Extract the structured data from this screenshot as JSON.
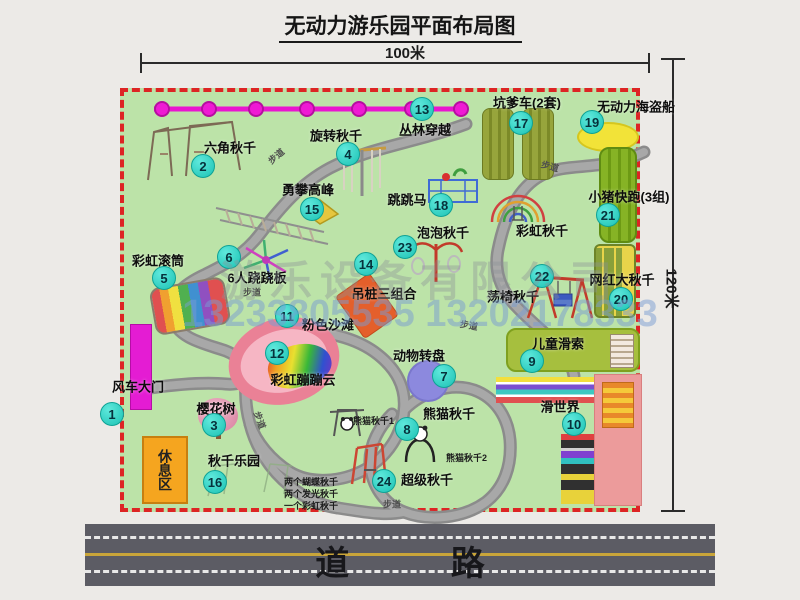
{
  "title": "无动力游乐园平面布局图",
  "dimensions": {
    "width_label": "100米",
    "height_label": "120米"
  },
  "road": {
    "label": "道 路"
  },
  "rest_area": {
    "label": "休息区"
  },
  "watermark": {
    "company": "游乐设备有限公司",
    "phone": "13233805535 13202178333"
  },
  "trail_label_text": "步道",
  "colors": {
    "map_green": "#bce3a8",
    "border_red": "#dd2424",
    "badge_cyan": "#1cc2b4",
    "zipline_magenta": "#e916cf",
    "gate_magenta": "#e41cd3",
    "rest_orange": "#f5a51f",
    "road_gray": "#5c5c64"
  },
  "attractions": [
    {
      "num": "1",
      "name": "风车大门",
      "nx": -12,
      "ny": 322,
      "lx": 14,
      "ly": 294
    },
    {
      "num": "2",
      "name": "六角秋千",
      "nx": 79,
      "ny": 74,
      "lx": 106,
      "ly": 55
    },
    {
      "num": "3",
      "name": "樱花树",
      "nx": 90,
      "ny": 333,
      "lx": 92,
      "ly": 316
    },
    {
      "num": "4",
      "name": "旋转秋千",
      "nx": 224,
      "ny": 62,
      "lx": 212,
      "ly": 43
    },
    {
      "num": "5",
      "name": "彩虹滚筒",
      "nx": 40,
      "ny": 186,
      "lx": 34,
      "ly": 168
    },
    {
      "num": "6",
      "name": "6人跷跷板",
      "nx": 105,
      "ny": 165,
      "lx": 133,
      "ly": 185
    },
    {
      "num": "7",
      "name": "动物转盘",
      "nx": 320,
      "ny": 284,
      "lx": 295,
      "ly": 263
    },
    {
      "num": "8",
      "name": "熊猫秋千",
      "nx": 283,
      "ny": 337,
      "lx": 325,
      "ly": 321
    },
    {
      "num": "9",
      "name": "儿童滑索",
      "nx": 408,
      "ny": 269,
      "lx": 434,
      "ly": 251
    },
    {
      "num": "10",
      "name": "滑世界",
      "nx": 450,
      "ny": 332,
      "lx": 436,
      "ly": 314
    },
    {
      "num": "11",
      "name": "粉色沙滩",
      "nx": 163,
      "ny": 224,
      "lx": 204,
      "ly": 232
    },
    {
      "num": "12",
      "name": "彩虹蹦蹦云",
      "nx": 153,
      "ny": 261,
      "lx": 179,
      "ly": 287
    },
    {
      "num": "13",
      "name": "丛林穿越",
      "nx": 298,
      "ny": 17,
      "lx": 301,
      "ly": 37
    },
    {
      "num": "14",
      "name": "吊桩三组合",
      "nx": 242,
      "ny": 172,
      "lx": 260,
      "ly": 201
    },
    {
      "num": "15",
      "name": "勇攀高峰",
      "nx": 188,
      "ny": 117,
      "lx": 184,
      "ly": 97
    },
    {
      "num": "16",
      "name": "秋千乐园",
      "nx": 91,
      "ny": 390,
      "lx": 110,
      "ly": 368
    },
    {
      "num": "17",
      "name": "坑爹车(2套)",
      "nx": 397,
      "ny": 31,
      "lx": 403,
      "ly": 10
    },
    {
      "num": "18",
      "name": "跳跳马",
      "nx": 317,
      "ny": 113,
      "lx": 283,
      "ly": 107
    },
    {
      "num": "19",
      "name": "无动力海盗船",
      "nx": 468,
      "ny": 30,
      "lx": 512,
      "ly": 14
    },
    {
      "num": "20",
      "name": "网红大秋千",
      "nx": 497,
      "ny": 207,
      "lx": 498,
      "ly": 187
    },
    {
      "num": "21",
      "name": "小猪快跑(3组)",
      "nx": 484,
      "ny": 123,
      "lx": 505,
      "ly": 104
    },
    {
      "num": "22",
      "name": "荡椅秋千",
      "nx": 418,
      "ny": 184,
      "lx": 389,
      "ly": 204
    },
    {
      "num": "23",
      "name": "泡泡秋千",
      "nx": 281,
      "ny": 155,
      "lx": 319,
      "ly": 140
    },
    {
      "num": "24",
      "name": "超级秋千",
      "nx": 260,
      "ny": 389,
      "lx": 303,
      "ly": 387
    },
    {
      "num": null,
      "name": "彩虹秋千",
      "lx": 418,
      "ly": 138
    }
  ],
  "annotations": [
    {
      "text": "熊猫秋千1",
      "x": 229,
      "y": 322
    },
    {
      "text": "熊猫秋千2",
      "x": 322,
      "y": 359
    },
    {
      "text": "两个蝴蝶秋千",
      "x": 160,
      "y": 383
    },
    {
      "text": "两个发光秋千",
      "x": 160,
      "y": 395
    },
    {
      "text": "一个彩虹秋千",
      "x": 160,
      "y": 407
    }
  ],
  "trail_labels": [
    {
      "x": 152,
      "y": 64,
      "rot": -40
    },
    {
      "x": 426,
      "y": 74,
      "rot": 15
    },
    {
      "x": 128,
      "y": 200,
      "rot": 0
    },
    {
      "x": 345,
      "y": 233,
      "rot": 10
    },
    {
      "x": 136,
      "y": 328,
      "rot": 70
    },
    {
      "x": 268,
      "y": 412,
      "rot": 0
    }
  ]
}
